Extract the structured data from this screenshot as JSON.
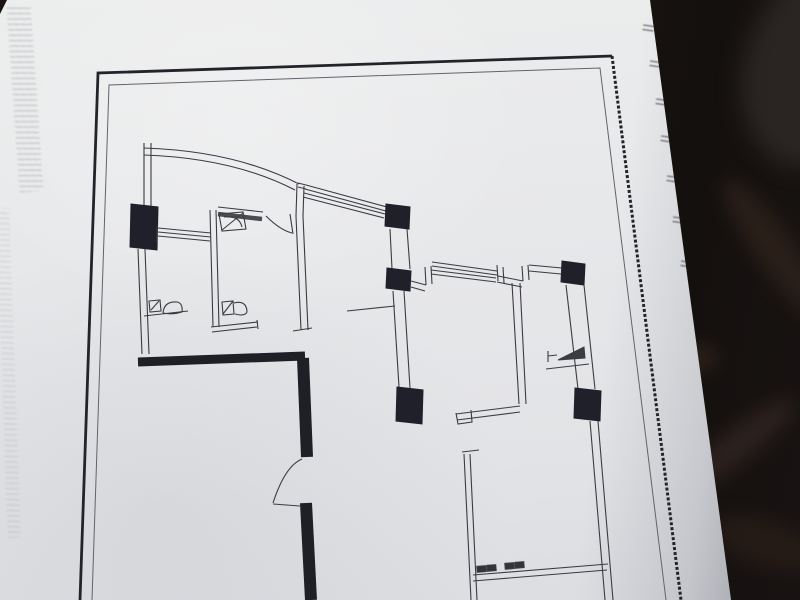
{
  "scene": {
    "description": "Photograph of a printed architectural floor plan on a tilted sheet of paper lying on a dark surface",
    "paper_color": "#e7e8ea",
    "background_color": "#1a1513",
    "ink_color": "#3b3b42",
    "heavy_wall_color": "#22222a",
    "border_color": "#26262c"
  },
  "annotations": {
    "left_margin_bleedthrough": {
      "legible": false,
      "orientation": "vertical",
      "style": "faint gray mirrored text"
    },
    "edge_marks_legible": false,
    "edge_marks": [
      {
        "x": 643,
        "y": 22
      },
      {
        "x": 650,
        "y": 58
      },
      {
        "x": 656,
        "y": 96
      },
      {
        "x": 661,
        "y": 133
      },
      {
        "x": 667,
        "y": 173
      },
      {
        "x": 673,
        "y": 214
      },
      {
        "x": 681,
        "y": 258
      }
    ]
  },
  "floorplan": {
    "elements": [
      {
        "name": "frame-outer-border",
        "tag": "path",
        "attrs": {
          "d": "M80,600 L98,73 L612,56",
          "stroke": "#23232a",
          "stroke-width": "2.8"
        }
      },
      {
        "name": "frame-outer-border-right",
        "tag": "path",
        "attrs": {
          "d": "M612,56 L681,600",
          "stroke": "#23232a",
          "stroke-width": "3",
          "stroke-dasharray": "3,2"
        }
      },
      {
        "name": "frame-inner-border",
        "tag": "path",
        "attrs": {
          "d": "M92,600 L109,85 L600,68 L666,600",
          "stroke": "#63636b",
          "stroke-width": "1"
        }
      },
      {
        "name": "balcony-wall-top",
        "tag": "path",
        "attrs": {
          "d": "M144,143 L144,207 M151,143 L151,207"
        }
      },
      {
        "name": "balcony-curved-wall",
        "tag": "path",
        "attrs": {
          "d": "M144,148 Q235,151 299,184 M144,155 Q233,158 295,190"
        }
      },
      {
        "name": "bay-window-band-1",
        "tag": "path",
        "attrs": {
          "d": "M298,183 L306,185 M298,187 L306,189 M306,185 L387,207 M305,189 L386,211 M304,193 L385,214 M303,197 L384,218"
        }
      },
      {
        "name": "column-c2",
        "tag": "polygon",
        "attrs": {
          "points": "386,204 410,207 409,229 385,226",
          "fill": "#20202a",
          "stroke": "#20202a"
        }
      },
      {
        "name": "wall-c2-c3",
        "tag": "path",
        "attrs": {
          "d": "M390,229 L392,269 M407,229 L410,269"
        }
      },
      {
        "name": "column-c3",
        "tag": "polygon",
        "attrs": {
          "points": "387,268 411,271 410,291 386,288",
          "fill": "#20202a",
          "stroke": "#20202a"
        }
      },
      {
        "name": "bay-window-2-left-step",
        "tag": "path",
        "attrs": {
          "d": "M411,281 L426,285 M411,287 L425,291 M425,267 L426,285 M431,266 L432,284"
        }
      },
      {
        "name": "bay-window-band-2",
        "tag": "path",
        "attrs": {
          "d": "M432,262 L497,271 M432,266 L497,275 M431,270 L496,278 M431,274 L496,282"
        }
      },
      {
        "name": "bay-window-2-right-step",
        "tag": "path",
        "attrs": {
          "d": "M497,265 L498,281 M503,267 L504,283"
        }
      },
      {
        "name": "connector-wall",
        "tag": "path",
        "attrs": {
          "d": "M498,276 L523,281 M497,282 L522,287"
        }
      },
      {
        "name": "window-right-step",
        "tag": "path",
        "attrs": {
          "d": "M522,266 L523,281 M528,265 L529,280"
        }
      },
      {
        "name": "window-right",
        "tag": "path",
        "attrs": {
          "d": "M529,265 L562,268 M529,271 L561,274"
        }
      },
      {
        "name": "column-c4",
        "tag": "polygon",
        "attrs": {
          "points": "562,261 585,264 584,285 561,282",
          "fill": "#20202a",
          "stroke": "#20202a"
        }
      },
      {
        "name": "east-wall-upper",
        "tag": "path",
        "attrs": {
          "d": "M566,285 L578,389 M584,285 L595,389"
        }
      },
      {
        "name": "column-c5",
        "tag": "polygon",
        "attrs": {
          "points": "575,388 601,391 600,421 574,418",
          "fill": "#20202a",
          "stroke": "#20202a"
        }
      },
      {
        "name": "east-wall-lower",
        "tag": "path",
        "attrs": {
          "d": "M590,421 L605,600 M598,421 L613,600"
        }
      },
      {
        "name": "interior-wall-b",
        "tag": "path",
        "attrs": {
          "d": "M512,283 L519,404 M520,283 L526,404"
        }
      },
      {
        "name": "room-b-bottom-wall",
        "tag": "path",
        "attrs": {
          "d": "M456,414 L520,406 M457,420 L520,412 M456,413 L458,424 L472,422 L471,410"
        }
      },
      {
        "name": "column-c6",
        "tag": "polygon",
        "attrs": {
          "points": "397,387 423,390 422,424 396,421",
          "fill": "#20202a",
          "stroke": "#20202a"
        }
      },
      {
        "name": "wall-c3-c6",
        "tag": "path",
        "attrs": {
          "d": "M393,291 L399,387 M404,291 L410,388"
        }
      },
      {
        "name": "thick-wall-horizontal",
        "tag": "path",
        "attrs": {
          "d": "M138,362 L305,356",
          "stroke": "#1f1f26",
          "stroke-width": "9"
        }
      },
      {
        "name": "thick-wall-vertical-upper",
        "tag": "path",
        "attrs": {
          "d": "M303,358 L307,457",
          "stroke": "#1f1f26",
          "stroke-width": "12"
        }
      },
      {
        "name": "thick-wall-vertical-lower",
        "tag": "path",
        "attrs": {
          "d": "M306,503 L311,600",
          "stroke": "#1f1f26",
          "stroke-width": "12"
        }
      },
      {
        "name": "entry-door-swing",
        "tag": "path",
        "attrs": {
          "d": "M302,459 Q285,466 273,503 M273,504 L300,506"
        }
      },
      {
        "name": "west-wall",
        "tag": "path",
        "attrs": {
          "d": "M138,249 L142,354 M145,249 L149,354"
        }
      },
      {
        "name": "column-c1",
        "tag": "polygon",
        "attrs": {
          "points": "131,204 158,207 157,250 130,247",
          "fill": "#20202a",
          "stroke": "#20202a"
        }
      },
      {
        "name": "window-left",
        "tag": "path",
        "attrs": {
          "d": "M157,226 L157,243 M158,228 L211,233 M158,232 L211,237 M158,236 L210,241"
        }
      },
      {
        "name": "bathroom-left-wall",
        "tag": "path",
        "attrs": {
          "d": "M210,210 L213,327 M216,210 L219,327"
        }
      },
      {
        "name": "bathroom-top-window-line",
        "tag": "path",
        "attrs": {
          "d": "M218,207 L263,212"
        }
      },
      {
        "name": "bathroom-top-window-band",
        "tag": "path",
        "attrs": {
          "d": "M218,214 L262,219",
          "stroke": "#4b4b52",
          "stroke-width": "4.5"
        }
      },
      {
        "name": "bathroom-door-swing",
        "tag": "path",
        "attrs": {
          "d": "M290,214 L293,234 M292,233 Q280,230 266,216"
        }
      },
      {
        "name": "hall-wall-mid",
        "tag": "path",
        "attrs": {
          "d": "M297,184 L296,216 M304,186 L303,216 M296,216 L301,330 M303,216 L308,330 M293,331 L312,328"
        }
      },
      {
        "name": "bathroom-bottom-wall",
        "tag": "path",
        "attrs": {
          "d": "M211,327 L258,322 M212,332 L257,327 M257,320 L258,329"
        }
      },
      {
        "name": "step-line",
        "tag": "path",
        "attrs": {
          "d": "M347,311 L395,306"
        }
      },
      {
        "name": "kitchen-counter",
        "tag": "path",
        "attrs": {
          "d": "M546,369 L589,364 M548,351 L548,362 M548,356 L557,355"
        }
      },
      {
        "name": "kitchen-fixture",
        "tag": "polygon",
        "attrs": {
          "points": "558,360 584,347 585,358",
          "fill": "#3b3b42",
          "stroke": "#3b3b42"
        }
      },
      {
        "name": "bottom-window-sill",
        "tag": "path",
        "attrs": {
          "d": "M473,575 L608,564 M473,581 L607,570"
        }
      },
      {
        "name": "sill-mark-1",
        "tag": "rect",
        "attrs": {
          "x": "477",
          "y": "566",
          "width": "9",
          "height": "6",
          "fill": "#33333a",
          "transform": "rotate(-4.5,481,569)"
        }
      },
      {
        "name": "sill-mark-2",
        "tag": "rect",
        "attrs": {
          "x": "487",
          "y": "565",
          "width": "9",
          "height": "6",
          "fill": "#33333a",
          "transform": "rotate(-4.5,491,568)"
        }
      },
      {
        "name": "sill-mark-3",
        "tag": "rect",
        "attrs": {
          "x": "505",
          "y": "563",
          "width": "9",
          "height": "6",
          "fill": "#33333a",
          "transform": "rotate(-4.5,509,566)"
        }
      },
      {
        "name": "sill-mark-4",
        "tag": "rect",
        "attrs": {
          "x": "515",
          "y": "562",
          "width": "9",
          "height": "6",
          "fill": "#33333a",
          "transform": "rotate(-4.5,519,565)"
        }
      },
      {
        "name": "bedroom-left-wall",
        "tag": "path",
        "attrs": {
          "d": "M464,454 L471,600 M470,454 L477,600 M462,452 L479,450"
        }
      },
      {
        "name": "toilet-fixture-left",
        "tag": "path",
        "attrs": {
          "d": "M144,316 L188,311 M149,301 L160,300 L161,311 L150,312 Z M151,310 L159,301 M163,313 Q164,301 177,302 Q183,303 182,312 Q173,315 163,313"
        }
      },
      {
        "name": "basin-fixture-top",
        "tag": "path",
        "attrs": {
          "d": "M219,214 L243,212 L246,229 L222,231 Z M224,217 Q239,215 242,227 M222,230 L243,213"
        }
      },
      {
        "name": "toilet-fixture-bath",
        "tag": "path",
        "attrs": {
          "d": "M222,302 L233,301 L234,314 L223,315 Z M223,314 L233,301 M234,303 Q246,300 247,311 Q247,315 240,315 L235,314"
        }
      }
    ]
  }
}
